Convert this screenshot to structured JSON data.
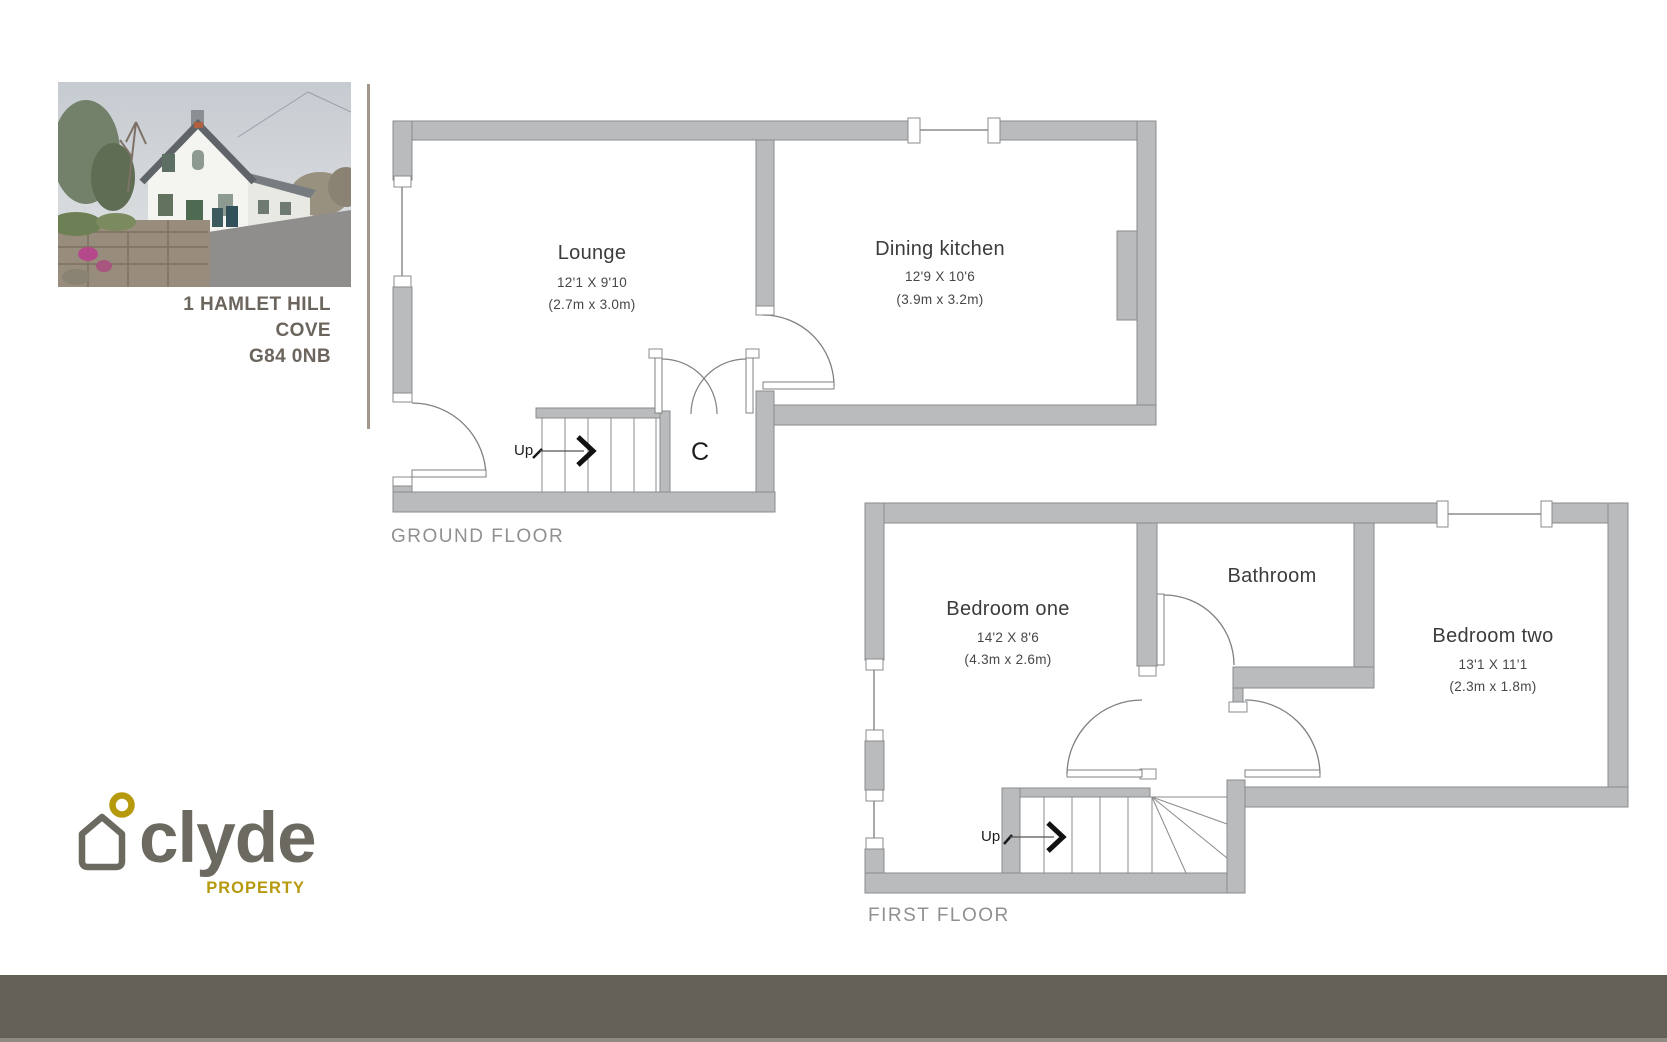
{
  "property": {
    "address_line1": "1 HAMLET HILL",
    "address_line2": "COVE",
    "address_line3": "G84 0NB"
  },
  "branding": {
    "name": "clyde",
    "tagline": "PROPERTY",
    "gray_color": "#6c6961",
    "gold_color": "#b7990e"
  },
  "plan": {
    "wall_fill": "#babbbd",
    "wall_border": "#8a8b8d",
    "line_color": "#7f8082",
    "ground": {
      "label": "GROUND FLOOR",
      "up_label": "Up",
      "closet_label": "C",
      "rooms": [
        {
          "id": "lounge",
          "name": "Lounge",
          "imperial": "12'1 X 9'10",
          "metric": "(2.7m x 3.0m)"
        },
        {
          "id": "dining-kitchen",
          "name": "Dining kitchen",
          "imperial": "12'9 X 10'6",
          "metric": "(3.9m x 3.2m)"
        }
      ]
    },
    "first": {
      "label": "FIRST FLOOR",
      "up_label": "Up",
      "rooms": [
        {
          "id": "bedroom-one",
          "name": "Bedroom one",
          "imperial": "14'2 X 8'6",
          "metric": "(4.3m x 2.6m)"
        },
        {
          "id": "bathroom",
          "name": "Bathroom"
        },
        {
          "id": "bedroom-two",
          "name": "Bedroom two",
          "imperial": "13'1 X 11'1",
          "metric": "(2.3m x 1.8m)"
        }
      ]
    }
  }
}
